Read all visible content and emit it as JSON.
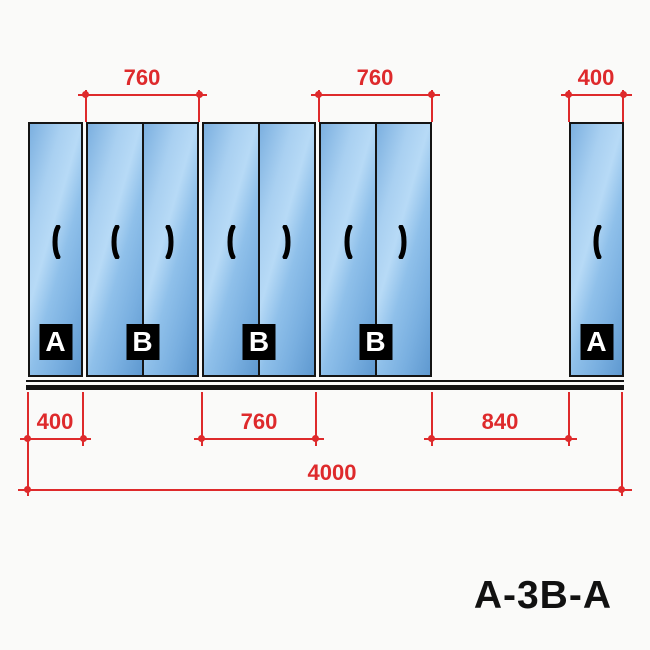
{
  "title": "A-3B-A",
  "colors": {
    "dimension_red": "#de2a2c",
    "outline_black": "#141414",
    "label_bg": "#000000",
    "label_text": "#ffffff",
    "panel_blue_light": "#b7daf6",
    "panel_blue_dark": "#5f99d0",
    "background": "#fafaf9"
  },
  "dims": {
    "top": [
      {
        "label": "760"
      },
      {
        "label": "760"
      },
      {
        "label": "400"
      }
    ],
    "bottom": [
      {
        "label": "400"
      },
      {
        "label": "760"
      },
      {
        "label": "840"
      }
    ],
    "overall": {
      "label": "4000"
    }
  },
  "panels": [
    {
      "label": "A"
    },
    {
      "label": "B"
    },
    {
      "label": "B"
    },
    {
      "label": "B"
    },
    {
      "label": "A"
    }
  ]
}
